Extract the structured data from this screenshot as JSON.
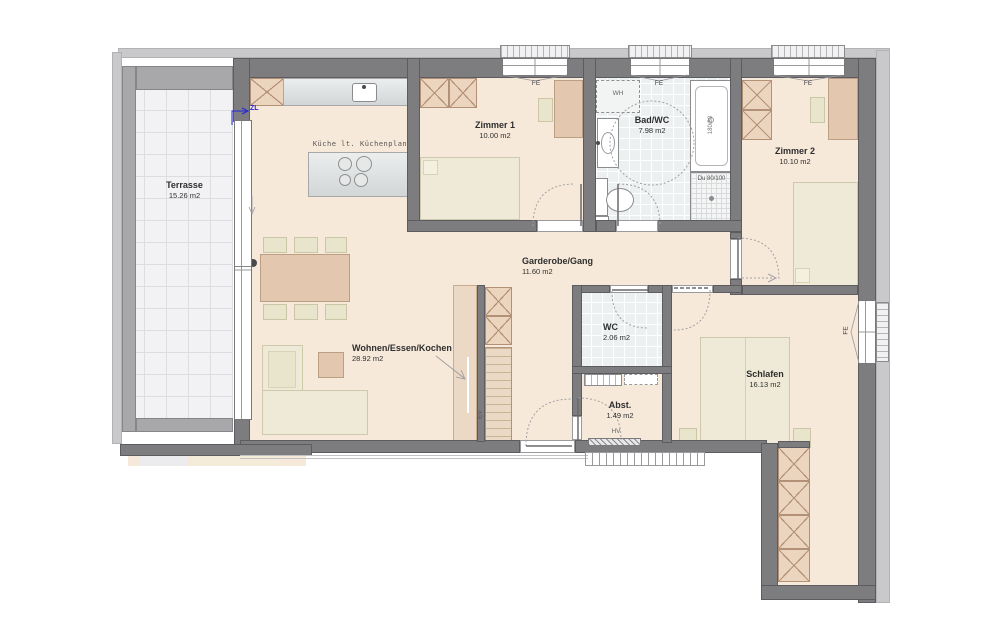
{
  "plan": {
    "rooms": [
      {
        "name": "Terrasse",
        "area": "15.26 m2"
      },
      {
        "name": "Zimmer 1",
        "area": "10.00 m2"
      },
      {
        "name": "Bad/WC",
        "area": "7.98 m2"
      },
      {
        "name": "Zimmer 2",
        "area": "10.10 m2"
      },
      {
        "name": "Garderobe/Gang",
        "area": "11.60 m2"
      },
      {
        "name": "Wohnen/Essen/Kochen",
        "area": "28.92 m2"
      },
      {
        "name": "WC",
        "area": "2.06 m2"
      },
      {
        "name": "Abst.",
        "area": "1.49 m2"
      },
      {
        "name": "Schlafen",
        "area": "16.13 m2"
      }
    ],
    "annotations": {
      "kitchen_note": "Küche lt. Küchenplan",
      "supply_air": "ZL",
      "window": "FE",
      "washer": "WH",
      "distributor": "HV",
      "built_in": "EV",
      "bathtub_size": "180/80",
      "shower_size": "Du 80/100"
    },
    "colors": {
      "wall": "#7d7d80",
      "wall_trim": "#c9c9cc",
      "parapet": "#a8a8ab",
      "floor": "#f7e9da",
      "tile_floor": "#edf0f0",
      "furniture_wood": "#e3c8af",
      "furniture_light": "#efead7",
      "annotation_blue": "#2222dd"
    }
  }
}
